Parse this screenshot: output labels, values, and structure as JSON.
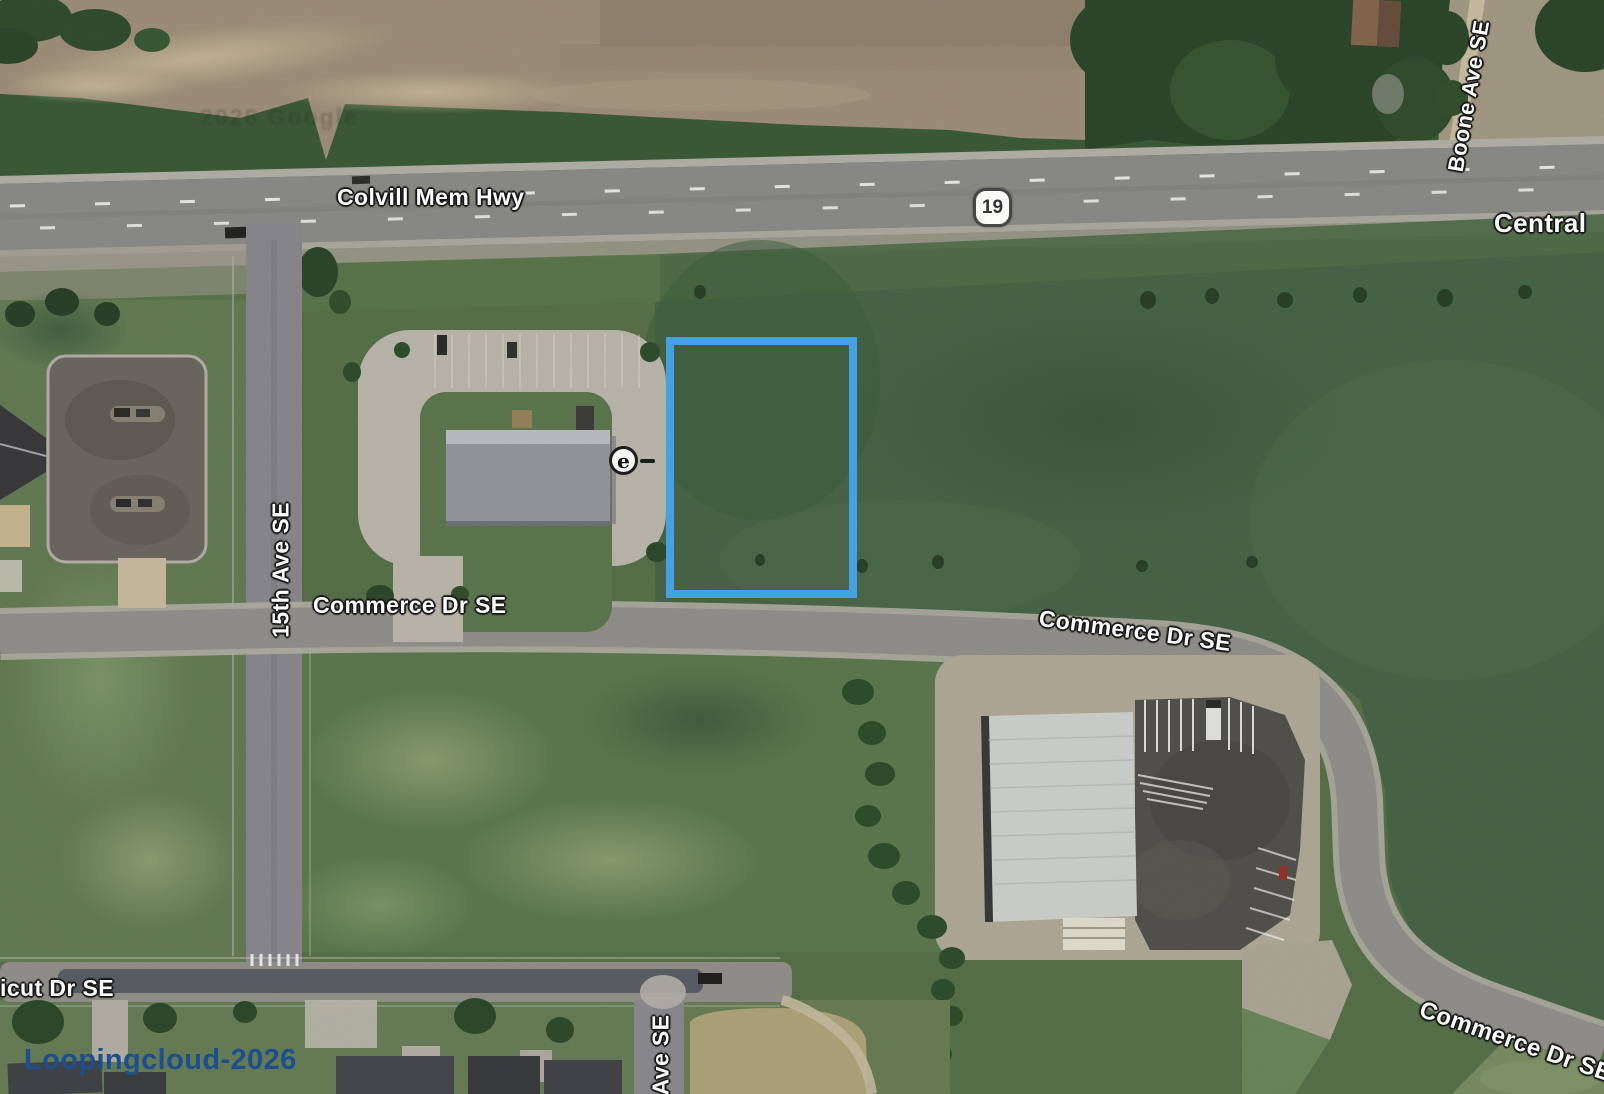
{
  "palette": {
    "highlight_blue": "#45a1e1",
    "watermark_blue": "#1b4f8e",
    "grass_base": "#5a744c",
    "north_green": "#3f5e3a",
    "dirt_field": "#a3937d",
    "dirt_field_right": "#a89e88",
    "dark_trees": "#2f4a2d",
    "highway_gray": "#8f8f8b",
    "road_gray": "#96948f",
    "dark_field": "#4b684a",
    "field_south": "#607c52",
    "field_west": "#677f58",
    "lawn": "#6a815a",
    "parking_light": "#c1bcb0",
    "parking_dark": "#56544f",
    "church_lot": "#6f6b64",
    "warehouse_roof": "#d3d6d2",
    "gravel": "#b5ae9c"
  },
  "map": {
    "road_labels": {
      "colvill": "Colvill Mem Hwy",
      "central": "Central",
      "boone": "Boone Ave SE",
      "fifteenth_ave": "15th Ave SE",
      "commerce_west": "Commerce Dr SE",
      "commerce_east": "Commerce Dr SE",
      "commerce_southeast": "Commerce Dr SE",
      "connecticut": "ticut Dr SE",
      "ave_se": "Ave SE"
    },
    "route_shield": {
      "number": "19"
    },
    "e_marker": "e",
    "watermark": "Loopingcloud-2026",
    "ghost_watermark": "2026 Google"
  }
}
